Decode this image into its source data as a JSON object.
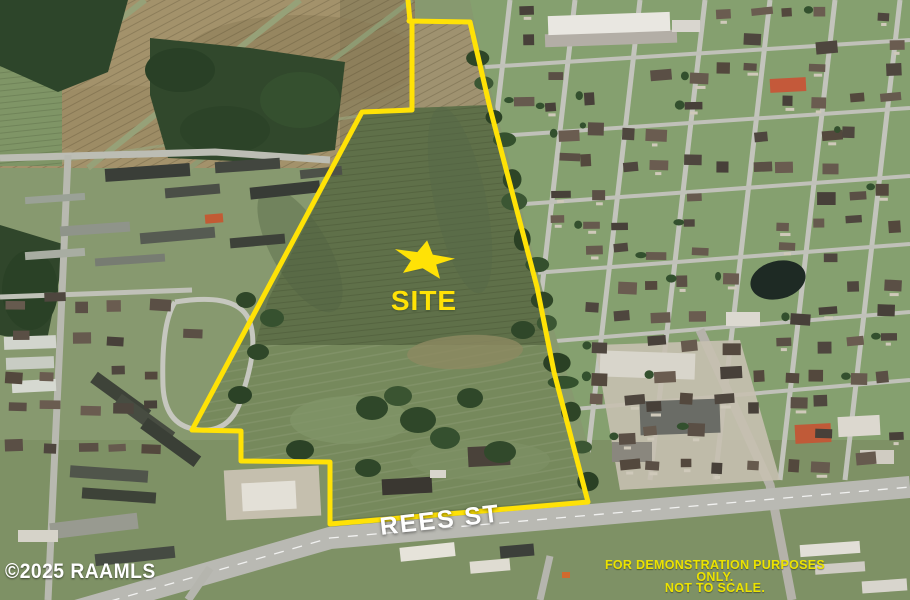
{
  "colors": {
    "boundary-yellow": "#ffe206",
    "label-white": "#ffffff",
    "disclaimer-yellow": "#ece300"
  },
  "boundary": {
    "points": "409,21 470,22 490,108 537,287 554,372 588,502 330,524 330,462 241,461 241,431 192,430 362,112 412,110 412,22",
    "stub_points": "410,21 408,0"
  },
  "site_marker": {
    "label": "SITE"
  },
  "street": {
    "label": "REES ST"
  },
  "watermark": {
    "text": "©2025 RAAMLS"
  },
  "disclaimer": {
    "line1": "FOR DEMONSTRATION PURPOSES ONLY.",
    "line2": "NOT TO SCALE."
  }
}
